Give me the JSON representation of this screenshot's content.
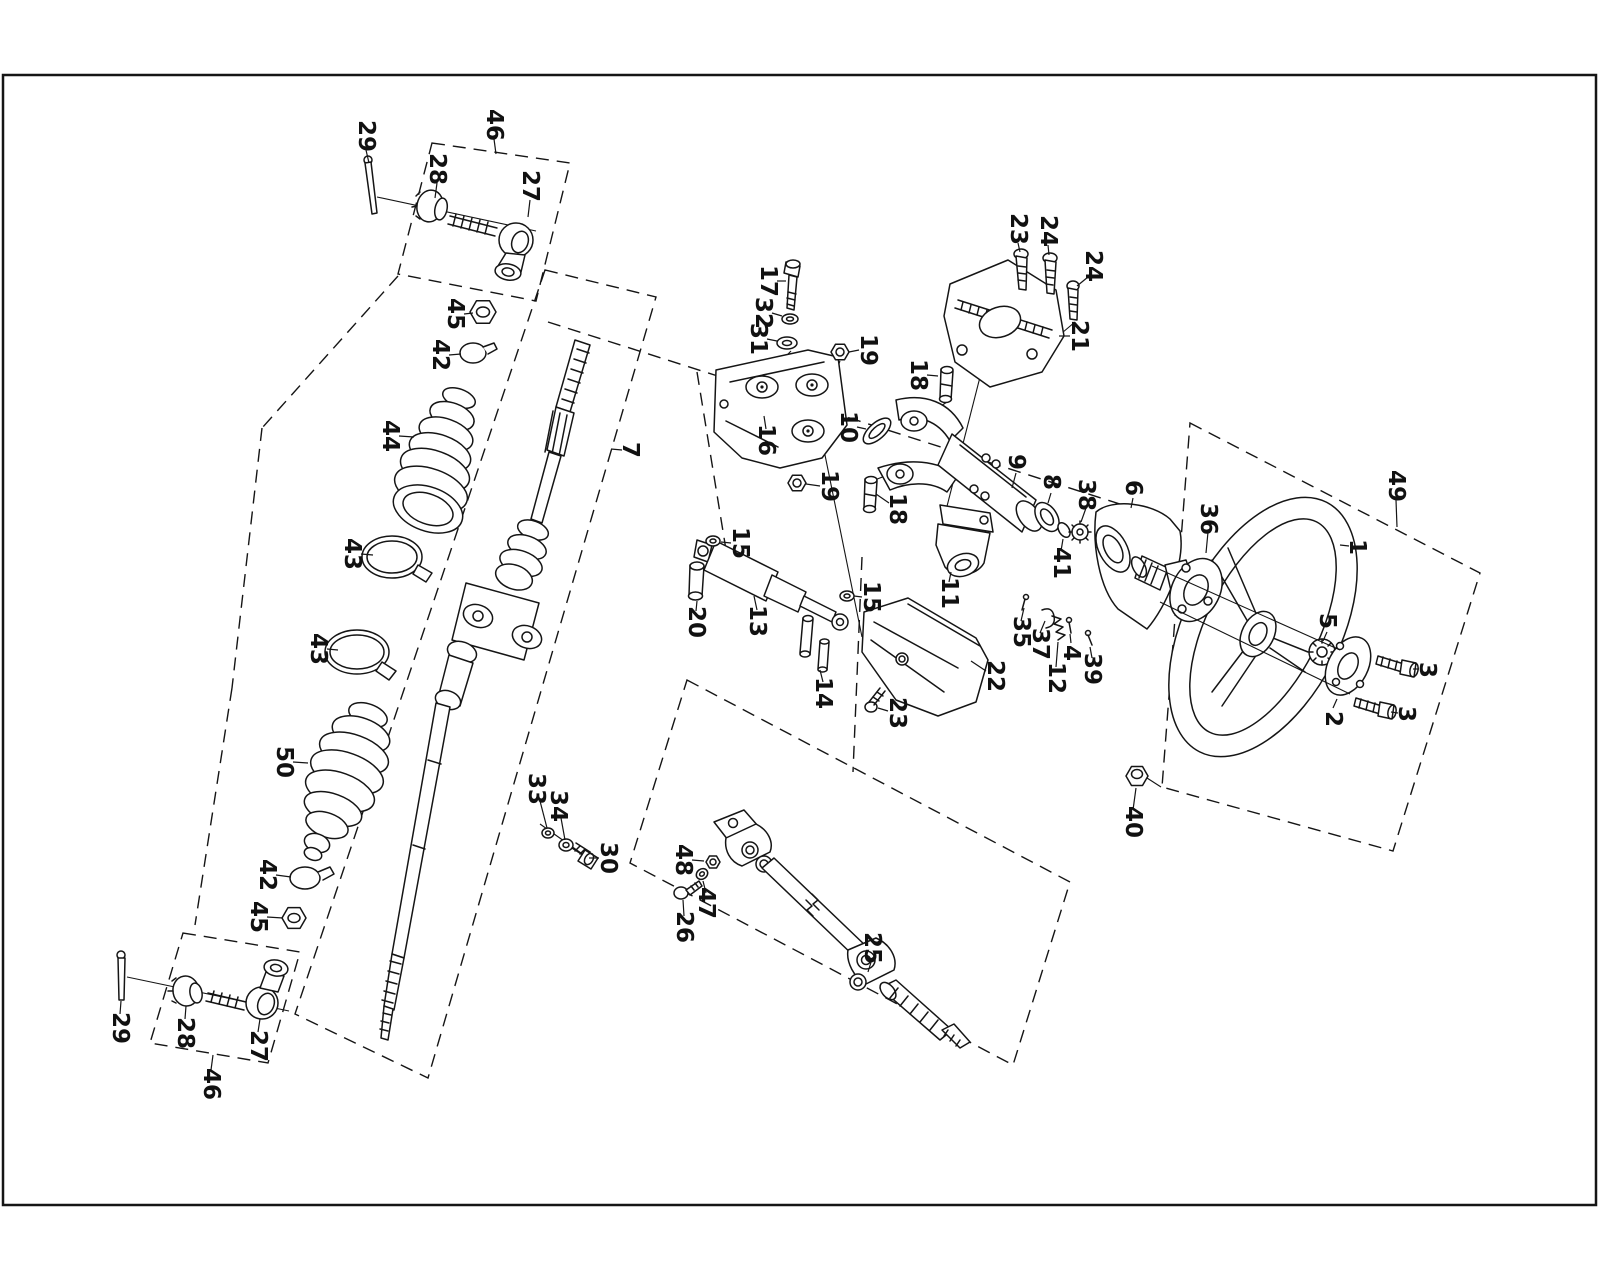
{
  "figure": {
    "kind": "exploded-parts-diagram",
    "subject": "steering column, rack and steering wheel assembly",
    "background": "#ffffff",
    "line_color": "#151515",
    "border": {
      "x": 3,
      "y": 75,
      "w": 1593,
      "h": 1130
    }
  },
  "labels": [
    {
      "text": "29",
      "x": 366,
      "y": 136,
      "lead": [
        366,
        150,
        369,
        163
      ]
    },
    {
      "text": "46",
      "x": 494,
      "y": 125,
      "lead": [
        494,
        139,
        496,
        154
      ]
    },
    {
      "text": "28",
      "x": 437,
      "y": 169,
      "lead": [
        437,
        183,
        435,
        198
      ]
    },
    {
      "text": "27",
      "x": 530,
      "y": 186,
      "lead": [
        530,
        200,
        528,
        217
      ]
    },
    {
      "text": "45",
      "x": 455,
      "y": 314,
      "lead": [
        464,
        314,
        473,
        313
      ]
    },
    {
      "text": "42",
      "x": 440,
      "y": 355,
      "lead": [
        449,
        355,
        461,
        354
      ]
    },
    {
      "text": "44",
      "x": 390,
      "y": 436,
      "lead": [
        399,
        436,
        414,
        437
      ]
    },
    {
      "text": "7",
      "x": 630,
      "y": 450,
      "lead": [
        622,
        450,
        611,
        449
      ]
    },
    {
      "text": "43",
      "x": 352,
      "y": 554,
      "lead": [
        361,
        554,
        373,
        555
      ]
    },
    {
      "text": "43",
      "x": 318,
      "y": 649,
      "lead": [
        327,
        649,
        338,
        650
      ]
    },
    {
      "text": "50",
      "x": 284,
      "y": 762,
      "lead": [
        293,
        762,
        308,
        763
      ]
    },
    {
      "text": "42",
      "x": 267,
      "y": 875,
      "lead": [
        276,
        875,
        291,
        877
      ]
    },
    {
      "text": "45",
      "x": 258,
      "y": 917,
      "lead": [
        267,
        917,
        283,
        918
      ]
    },
    {
      "text": "29",
      "x": 120,
      "y": 1028,
      "lead": [
        120,
        1014,
        121,
        1001
      ]
    },
    {
      "text": "28",
      "x": 185,
      "y": 1033,
      "lead": [
        185,
        1019,
        186,
        1006
      ]
    },
    {
      "text": "27",
      "x": 258,
      "y": 1046,
      "lead": [
        258,
        1032,
        260,
        1019
      ]
    },
    {
      "text": "46",
      "x": 211,
      "y": 1084,
      "lead": [
        211,
        1070,
        213,
        1055
      ]
    },
    {
      "text": "33",
      "x": 536,
      "y": 789,
      "lead": [
        540,
        801,
        547,
        828
      ]
    },
    {
      "text": "34",
      "x": 558,
      "y": 806,
      "lead": [
        561,
        818,
        565,
        840
      ]
    },
    {
      "text": "30",
      "x": 608,
      "y": 858,
      "lead": [
        599,
        858,
        589,
        858
      ]
    },
    {
      "text": "17",
      "x": 768,
      "y": 281,
      "lead": [
        777,
        281,
        786,
        281
      ]
    },
    {
      "text": "32",
      "x": 763,
      "y": 313,
      "lead": [
        772,
        313,
        782,
        316
      ]
    },
    {
      "text": "31",
      "x": 758,
      "y": 339,
      "lead": [
        767,
        339,
        777,
        341
      ]
    },
    {
      "text": "16",
      "x": 766,
      "y": 440,
      "lead": [
        766,
        429,
        764,
        416
      ]
    },
    {
      "text": "10",
      "x": 848,
      "y": 427,
      "lead": [
        857,
        427,
        866,
        429
      ]
    },
    {
      "text": "19",
      "x": 868,
      "y": 350,
      "lead": [
        859,
        350,
        849,
        352
      ]
    },
    {
      "text": "19",
      "x": 829,
      "y": 486,
      "lead": [
        820,
        486,
        806,
        484
      ]
    },
    {
      "text": "18",
      "x": 918,
      "y": 375,
      "lead": [
        927,
        375,
        938,
        376
      ]
    },
    {
      "text": "18",
      "x": 897,
      "y": 509,
      "lead": [
        889,
        503,
        876,
        494
      ]
    },
    {
      "text": "23",
      "x": 1018,
      "y": 229,
      "lead": [
        1018,
        243,
        1020,
        252
      ]
    },
    {
      "text": "24",
      "x": 1048,
      "y": 231,
      "lead": [
        1048,
        245,
        1049,
        255
      ]
    },
    {
      "text": "24",
      "x": 1093,
      "y": 266,
      "lead": [
        1088,
        277,
        1077,
        286
      ]
    },
    {
      "text": "21",
      "x": 1079,
      "y": 336,
      "lead": [
        1070,
        336,
        1059,
        336
      ]
    },
    {
      "text": "9",
      "x": 1016,
      "y": 462,
      "lead": [
        1016,
        473,
        1012,
        488
      ]
    },
    {
      "text": "8",
      "x": 1051,
      "y": 482,
      "lead": [
        1051,
        493,
        1048,
        503
      ]
    },
    {
      "text": "38",
      "x": 1086,
      "y": 495,
      "lead": [
        1086,
        508,
        1081,
        522
      ]
    },
    {
      "text": "41",
      "x": 1061,
      "y": 563,
      "lead": [
        1061,
        551,
        1063,
        539
      ]
    },
    {
      "text": "6",
      "x": 1133,
      "y": 488,
      "lead": [
        1133,
        498,
        1131,
        508
      ]
    },
    {
      "text": "11",
      "x": 949,
      "y": 593,
      "lead": [
        949,
        582,
        951,
        572
      ]
    },
    {
      "text": "15",
      "x": 740,
      "y": 543,
      "lead": [
        731,
        543,
        721,
        542
      ]
    },
    {
      "text": "20",
      "x": 696,
      "y": 622,
      "lead": [
        696,
        611,
        697,
        601
      ]
    },
    {
      "text": "13",
      "x": 757,
      "y": 621,
      "lead": [
        757,
        610,
        754,
        596
      ]
    },
    {
      "text": "15",
      "x": 871,
      "y": 597,
      "lead": [
        862,
        597,
        854,
        596
      ]
    },
    {
      "text": "14",
      "x": 823,
      "y": 693,
      "lead": [
        823,
        682,
        820,
        670
      ]
    },
    {
      "text": "22",
      "x": 995,
      "y": 676,
      "lead": [
        986,
        671,
        971,
        661
      ]
    },
    {
      "text": "23",
      "x": 897,
      "y": 713,
      "lead": [
        888,
        711,
        878,
        708
      ]
    },
    {
      "text": "35",
      "x": 1021,
      "y": 632,
      "lead": [
        1021,
        621,
        1024,
        608
      ]
    },
    {
      "text": "37",
      "x": 1040,
      "y": 644,
      "lead": [
        1040,
        633,
        1045,
        621
      ]
    },
    {
      "text": "4",
      "x": 1071,
      "y": 653,
      "lead": [
        1071,
        643,
        1070,
        634
      ]
    },
    {
      "text": "12",
      "x": 1056,
      "y": 678,
      "lead": [
        1056,
        667,
        1058,
        642
      ]
    },
    {
      "text": "39",
      "x": 1092,
      "y": 669,
      "lead": [
        1092,
        658,
        1090,
        647
      ]
    },
    {
      "text": "36",
      "x": 1208,
      "y": 519,
      "lead": [
        1208,
        532,
        1206,
        553
      ]
    },
    {
      "text": "49",
      "x": 1396,
      "y": 486,
      "lead": [
        1396,
        500,
        1397,
        527
      ]
    },
    {
      "text": "1",
      "x": 1357,
      "y": 547,
      "lead": [
        1349,
        546,
        1340,
        545
      ]
    },
    {
      "text": "5",
      "x": 1327,
      "y": 621,
      "lead": [
        1327,
        632,
        1323,
        641
      ]
    },
    {
      "text": "3",
      "x": 1427,
      "y": 670,
      "lead": [
        1419,
        669,
        1413,
        669
      ]
    },
    {
      "text": "2",
      "x": 1333,
      "y": 719,
      "lead": [
        1333,
        708,
        1337,
        699
      ]
    },
    {
      "text": "3",
      "x": 1406,
      "y": 714,
      "lead": [
        1398,
        713,
        1391,
        712
      ]
    },
    {
      "text": "40",
      "x": 1133,
      "y": 822,
      "lead": [
        1133,
        810,
        1136,
        788
      ]
    },
    {
      "text": "48",
      "x": 683,
      "y": 860,
      "lead": [
        692,
        860,
        704,
        861
      ]
    },
    {
      "text": "47",
      "x": 706,
      "y": 903,
      "lead": [
        706,
        893,
        703,
        881
      ]
    },
    {
      "text": "26",
      "x": 684,
      "y": 927,
      "lead": [
        684,
        916,
        683,
        900
      ]
    },
    {
      "text": "25",
      "x": 872,
      "y": 948,
      "lead": [
        872,
        959,
        868,
        972
      ]
    }
  ],
  "dashed_boxes": [
    {
      "name": "kit-box-tie-rod-top",
      "points": "432,143 570,163 536,301 398,274"
    },
    {
      "name": "kit-box-rack",
      "points": "545,270 656,297 428,1078 295,1014"
    },
    {
      "name": "kit-box-tie-rod-bottom",
      "points": "183,933 300,952 268,1063 150,1043"
    },
    {
      "name": "kit-box-steering-wheel",
      "points": "1190,423 1480,573 1393,851 1162,787"
    },
    {
      "name": "kit-box-intermediate-shaft",
      "points": "687,680 1070,882 1013,1065 630,863"
    }
  ],
  "dashed_lines": [
    [
      548,
      322,
      1145,
      512
    ],
    [
      697,
      372,
      728,
      562
    ],
    [
      862,
      557,
      853,
      772
    ],
    [
      398,
      276,
      262,
      428
    ],
    [
      262,
      428,
      232,
      688
    ],
    [
      232,
      688,
      195,
      925
    ]
  ],
  "solid_lines": [
    [
      377,
      197,
      536,
      231
    ],
    [
      127,
      977,
      289,
      1011
    ],
    [
      1022,
      292,
      991,
      329
    ],
    [
      1052,
      298,
      1011,
      341
    ],
    [
      1075,
      322,
      1031,
      359
    ],
    [
      991,
      334,
      944,
      518
    ],
    [
      813,
      396,
      862,
      637
    ],
    [
      791,
      351,
      764,
      379
    ],
    [
      840,
      361,
      834,
      377
    ],
    [
      947,
      402,
      921,
      419
    ],
    [
      872,
      481,
      893,
      473
    ],
    [
      588,
      858,
      540,
      824
    ],
    [
      1147,
      778,
      1161,
      787
    ]
  ],
  "overlay_lines": [
    [
      1152,
      566,
      1340,
      650
    ],
    [
      1160,
      602,
      1350,
      694
    ]
  ]
}
